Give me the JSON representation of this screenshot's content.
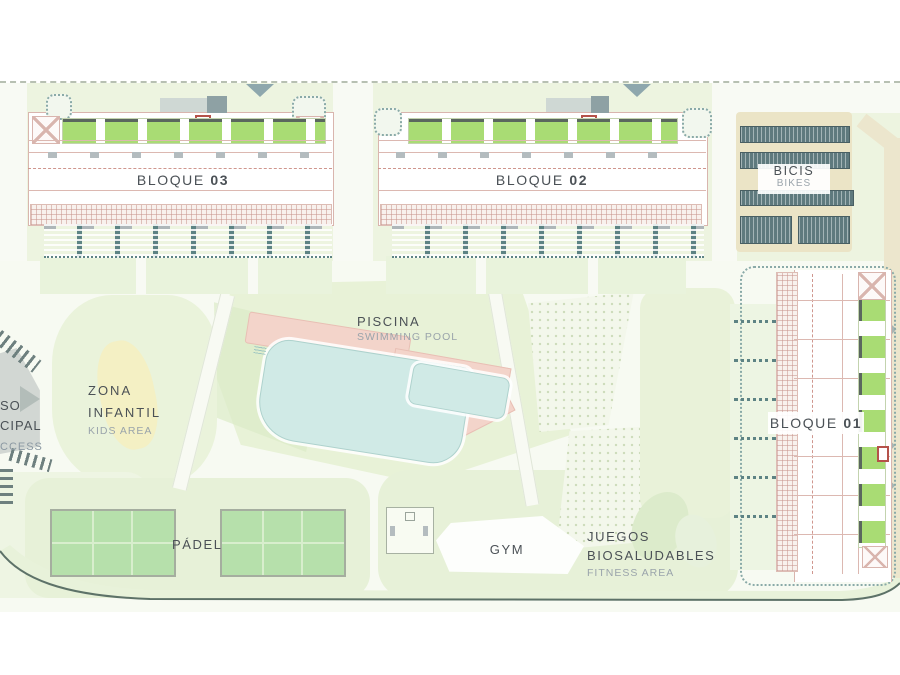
{
  "plan": {
    "blocks": {
      "b03": {
        "name": "BLOQUE",
        "number": "03"
      },
      "b02": {
        "name": "BLOQUE",
        "number": "02"
      },
      "b01": {
        "name": "BLOQUE",
        "number": "01"
      }
    },
    "amenities": {
      "bikes": {
        "title": "BICIS",
        "subtitle": "BIKES"
      },
      "pool": {
        "title": "PISCINA",
        "subtitle": "SWIMMING POOL"
      },
      "kids": {
        "line1": "ZONA",
        "line2": "INFANTIL",
        "subtitle": "KIDS AREA"
      },
      "padel": {
        "title": "PÁDEL"
      },
      "gym": {
        "title": "GYM"
      },
      "fitness": {
        "line1": "JUEGOS",
        "line2": "BIOSALUDABLES",
        "subtitle": "FITNESS AREA"
      }
    },
    "access_road": {
      "line1": "SO",
      "line2": "CIPAL",
      "line3": "CCESS"
    },
    "colors": {
      "balcony_green": "#a9dc74",
      "pool_water": "#d0eae6",
      "pool_deck": "#f3d4ca",
      "padel_court": "#b6e0ab",
      "bike_rack": "#5f7a7e",
      "road_beige": "#ece6cd",
      "kids_yellow": "#f6efc0",
      "building_line": "#c9938f",
      "hedge_teal": "#8aaaa8",
      "text_dark": "#4b5156",
      "text_muted": "#9aa4ab"
    }
  }
}
